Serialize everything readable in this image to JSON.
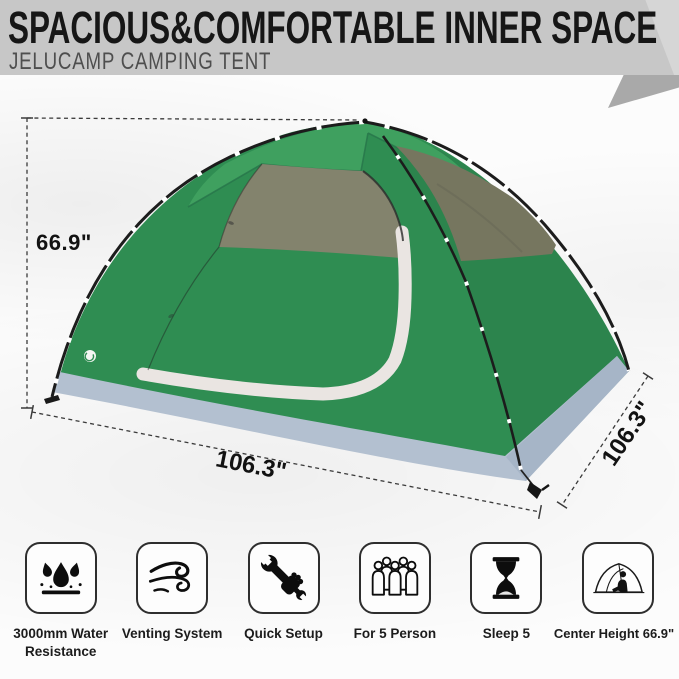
{
  "header": {
    "title": "SPACIOUS&COMFORTABLE INNER SPACE",
    "subtitle": "JELUCAMP CAMPING TENT"
  },
  "dimensions": {
    "height": "66.9\"",
    "width": "106.3\"",
    "depth": "106.3\""
  },
  "features": [
    {
      "icon": "water-drops-icon",
      "label": "3000mm Water Resistance"
    },
    {
      "icon": "wind-icon",
      "label": "Venting System"
    },
    {
      "icon": "wrench-icon",
      "label": "Quick Setup"
    },
    {
      "icon": "people-icon",
      "label": "For 5 Person"
    },
    {
      "icon": "hourglass-icon",
      "label": "Sleep 5"
    },
    {
      "icon": "tent-height-icon",
      "label": "Center Height 66.9\""
    }
  ],
  "colors": {
    "green": "#2F8D52",
    "green_light": "#3FA05F",
    "green_seam": "#27744A",
    "mesh": "#83836D",
    "mesh_dark": "#76765F",
    "skirt": "#B3C0D0",
    "skirt_dark": "#A6B5C7",
    "trim": "#EAE5E2",
    "pole": "#1C1C1C",
    "dash": "#3A3A3A",
    "header_bg": "#C7C7C7",
    "header_tri": "#A9A9A9"
  }
}
